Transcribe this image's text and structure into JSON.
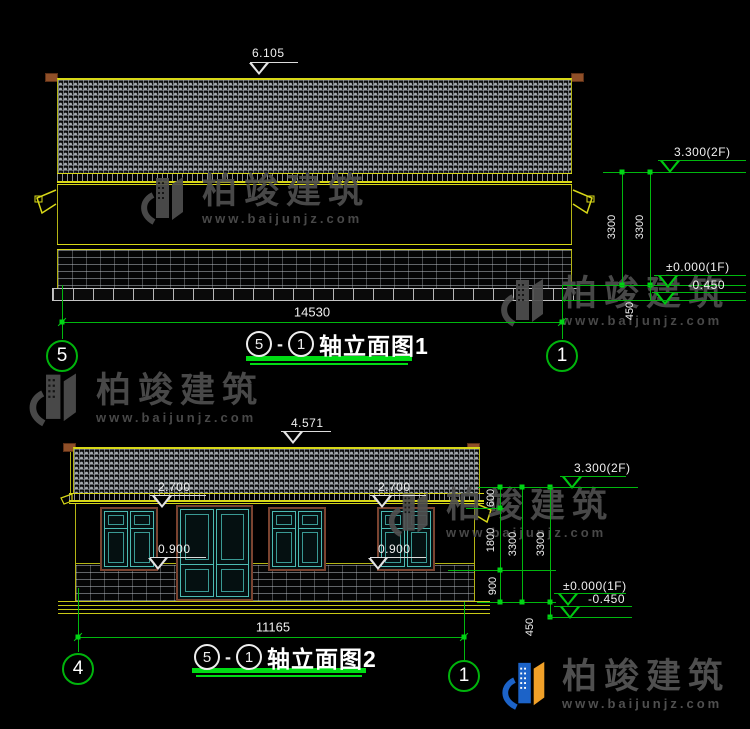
{
  "watermark": {
    "brand": "柏竣建筑",
    "url": "www.baijunjz.com"
  },
  "footer_logo": {
    "brand": "柏竣建筑",
    "url": "www.baijunjz.com"
  },
  "drawing1": {
    "ridge_level": "6.105",
    "width_dim": "14530",
    "axis_left": "5",
    "axis_right": "1",
    "title": {
      "bubble_left": "5",
      "dash": "-",
      "bubble_right": "1",
      "label": "轴立面图1"
    },
    "levels": {
      "floor2": "3.300(2F)",
      "floor1": "±0.000(1F)",
      "below_grade": "-0.450"
    },
    "vdims": {
      "story_a": "3300",
      "story_b": "3300",
      "plinth": "450"
    }
  },
  "drawing2": {
    "ridge_level": "4.571",
    "width_dim": "11165",
    "axis_left": "4",
    "axis_right": "1",
    "title": {
      "bubble_left": "5",
      "dash": "-",
      "bubble_right": "1",
      "label": "轴立面图2"
    },
    "window_levels": {
      "head_a": "2.700",
      "head_b": "2.700",
      "sill_a": "0.900",
      "sill_b": "0.900"
    },
    "levels": {
      "floor2": "3.300(2F)",
      "floor1": "±0.000(1F)",
      "below_grade": "-0.450"
    },
    "vdims": {
      "parapet": "600",
      "window": "1800",
      "sill": "900",
      "story_a": "3300",
      "story_b": "3300",
      "plinth": "450"
    }
  },
  "colors": {
    "cad_yellow": "#d8d818",
    "cad_green": "#00c812",
    "teal_window": "#4cbab2",
    "frame_brown": "#7a4330",
    "cap_brown": "#8f4f28",
    "watermark_gray": "#4f4f4f",
    "logo_blue": "#1c63c8",
    "logo_orange": "#f0a028"
  }
}
